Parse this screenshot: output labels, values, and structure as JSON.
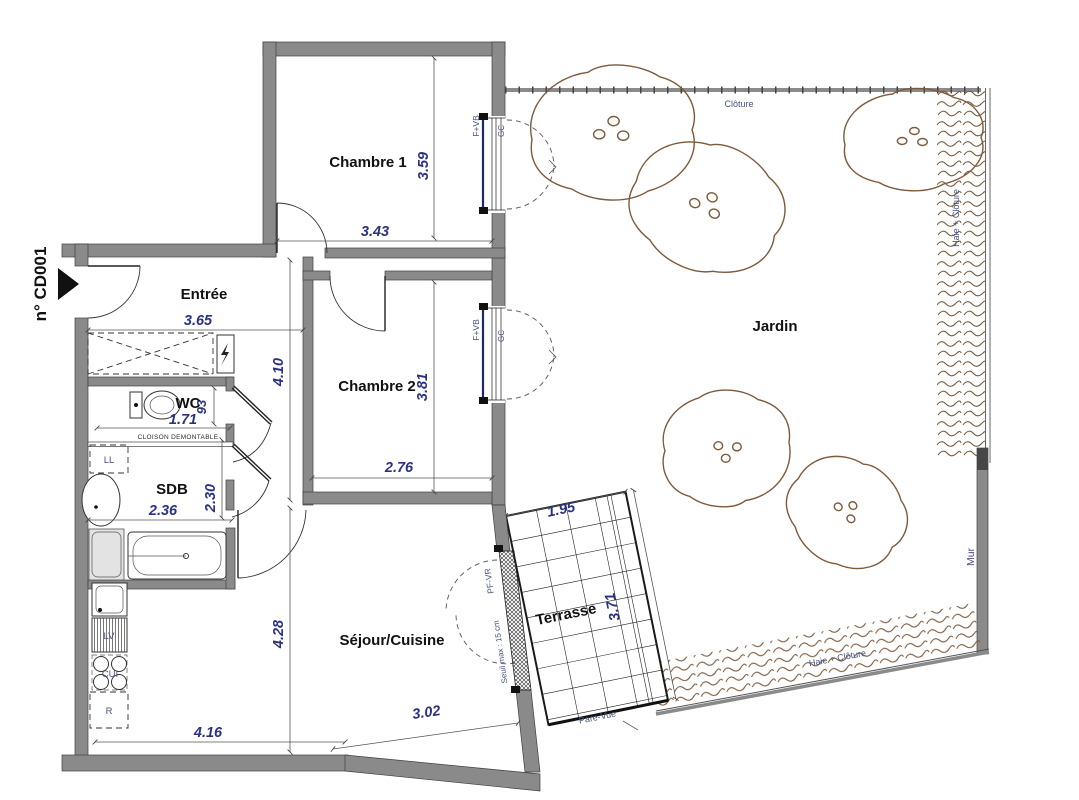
{
  "plan": {
    "reference": "n° CD001",
    "rooms": {
      "chambre1": {
        "label": "Chambre 1",
        "dim_width": "3.43",
        "dim_height": "3.59"
      },
      "chambre2": {
        "label": "Chambre 2",
        "dim_width": "2.76",
        "dim_height": "3.81"
      },
      "entree": {
        "label": "Entrée",
        "dim_width": "3.65",
        "dim_height": "4.10"
      },
      "wc": {
        "label": "WC",
        "dim_width": "1.71",
        "dim_height": "93"
      },
      "sdb": {
        "label": "SDB",
        "dim_width": "2.36",
        "dim_height": "2.30"
      },
      "sejour": {
        "label": "Séjour/Cuisine",
        "dim_width": "3.02",
        "dim_width_2": "4.16",
        "dim_height": "4.28"
      },
      "terrasse": {
        "label": "Terrasse",
        "dim_width": "1.95",
        "dim_height": "3.71"
      },
      "jardin": {
        "label": "Jardin"
      }
    },
    "annotations": {
      "cloison_demontable": "CLOISON DEMONTABLE",
      "cloture": "Clôture",
      "haie_cloture_right": "Haie + Clôture",
      "haie_cloture_bottom": "Haie + Clôture",
      "mur": "Mur",
      "pare_vue": "Pare-Vue",
      "seuil": "Seuil max : 15 cm",
      "window_fvb_1": "F+VB",
      "window_gc_1": "GC",
      "window_fvb_2": "F+VB",
      "window_gc_2": "GC",
      "window_pfvr": "PF-VR"
    },
    "appliances": {
      "ll": "LL",
      "lv": "LV",
      "cui": "CUI",
      "r": "R"
    },
    "colors": {
      "wall": "#8a8a8a",
      "dimension_text": "#2b3380",
      "annotation_text": "#46537f",
      "vegetation": "#7d5a3c",
      "line": "#222222",
      "glazing": "#1e2a66"
    }
  }
}
